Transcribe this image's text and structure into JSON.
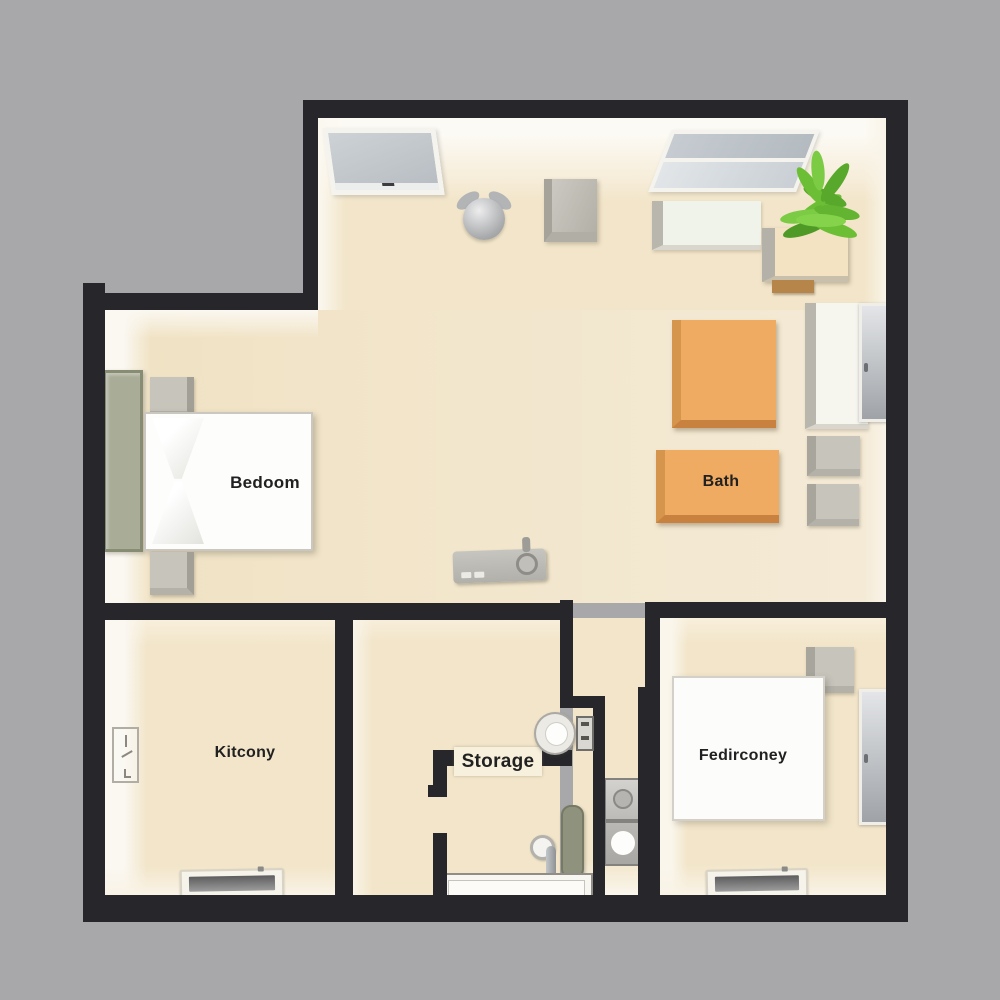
{
  "scene": {
    "type": "3d-floor-plan-top-view",
    "background_color": "#a8a8aa",
    "wall_color": "#26262b",
    "floor_color": "#f2e5c9",
    "accent_orange": "#eeab61",
    "accent_sage": "#a9ad97",
    "plant_green": "#6cbf35"
  },
  "labels": {
    "bedroom": "Bedoom",
    "bath": "Bath",
    "kitchen": "Kitcony",
    "storage": "Storage",
    "bedroom2": "Fedirconey"
  },
  "items": [
    "bed",
    "pillows",
    "nightstand",
    "wardrobe",
    "window",
    "double-window",
    "ceiling-lamp",
    "storage-cube",
    "bench",
    "potted-fern",
    "planter",
    "tall-cabinet",
    "wall-door",
    "side-table",
    "bath-block",
    "remote-console",
    "toilet",
    "control-panel",
    "faucet",
    "towel-bar",
    "sink-counter",
    "washer-dryer-stack",
    "area-rug",
    "floor-vent",
    "light-switch-panel"
  ]
}
